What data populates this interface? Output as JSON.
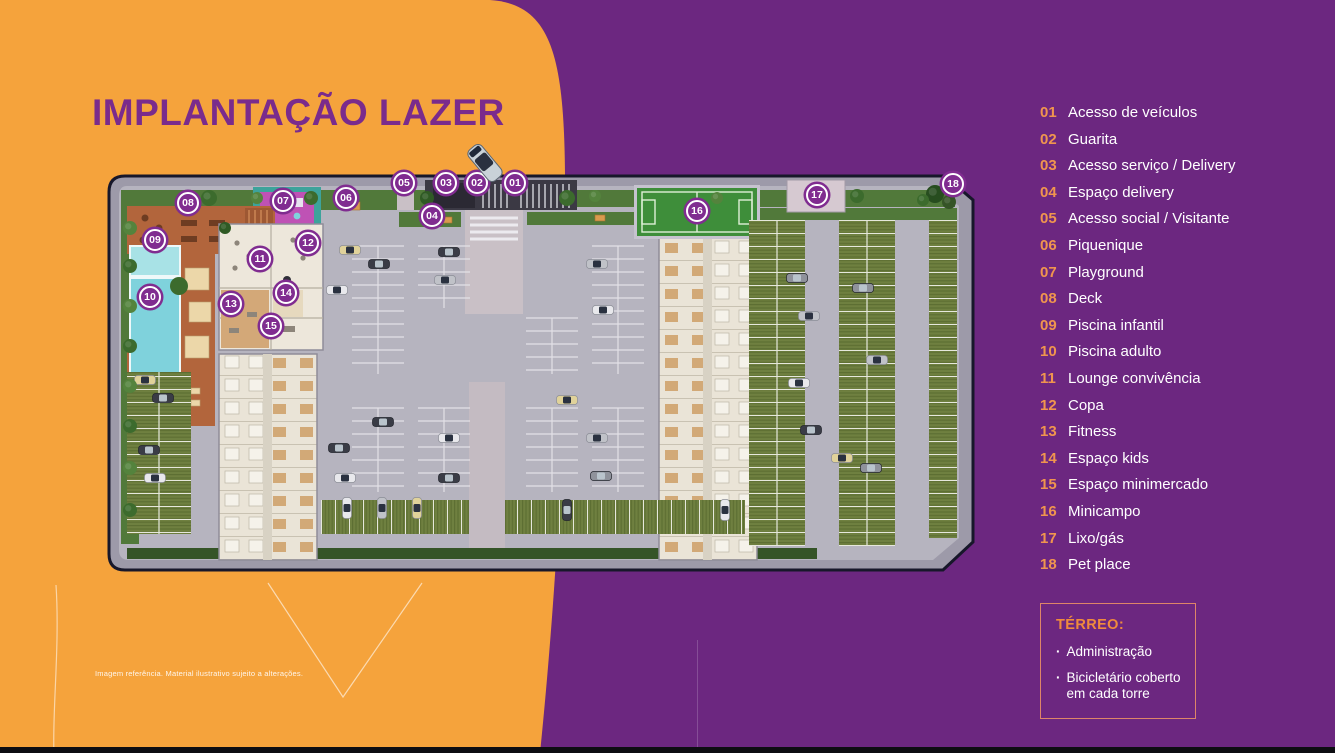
{
  "title": "IMPLANTAÇÃO LAZER",
  "legend": {
    "items": [
      {
        "num": "01",
        "label": "Acesso de veículos"
      },
      {
        "num": "02",
        "label": "Guarita"
      },
      {
        "num": "03",
        "label": "Acesso serviço / Delivery"
      },
      {
        "num": "04",
        "label": "Espaço delivery"
      },
      {
        "num": "05",
        "label": "Acesso social / Visitante"
      },
      {
        "num": "06",
        "label": "Piquenique"
      },
      {
        "num": "07",
        "label": "Playground"
      },
      {
        "num": "08",
        "label": "Deck"
      },
      {
        "num": "09",
        "label": "Piscina infantil"
      },
      {
        "num": "10",
        "label": "Piscina adulto"
      },
      {
        "num": "11",
        "label": "Lounge convivência"
      },
      {
        "num": "12",
        "label": "Copa"
      },
      {
        "num": "13",
        "label": "Fitness"
      },
      {
        "num": "14",
        "label": "Espaço kids"
      },
      {
        "num": "15",
        "label": "Espaço minimercado"
      },
      {
        "num": "16",
        "label": "Minicampo"
      },
      {
        "num": "17",
        "label": "Lixo/gás"
      },
      {
        "num": "18",
        "label": "Pet place"
      }
    ]
  },
  "terreo_box": {
    "heading": "TÉRREO:",
    "items": [
      "Administração",
      "Bicicletário coberto em cada torre"
    ]
  },
  "disclaimer": "Imagem referência. Material ilustrativo sujeito a alterações.",
  "plan": {
    "markers": [
      {
        "num": "01",
        "x": 418,
        "y": 15
      },
      {
        "num": "02",
        "x": 380,
        "y": 15
      },
      {
        "num": "03",
        "x": 349,
        "y": 15
      },
      {
        "num": "04",
        "x": 335,
        "y": 48
      },
      {
        "num": "05",
        "x": 307,
        "y": 15
      },
      {
        "num": "06",
        "x": 249,
        "y": 30
      },
      {
        "num": "07",
        "x": 186,
        "y": 33
      },
      {
        "num": "08",
        "x": 91,
        "y": 35
      },
      {
        "num": "09",
        "x": 58,
        "y": 72
      },
      {
        "num": "10",
        "x": 53,
        "y": 129
      },
      {
        "num": "11",
        "x": 163,
        "y": 91
      },
      {
        "num": "12",
        "x": 211,
        "y": 75
      },
      {
        "num": "13",
        "x": 134,
        "y": 136
      },
      {
        "num": "14",
        "x": 189,
        "y": 125
      },
      {
        "num": "15",
        "x": 174,
        "y": 158
      },
      {
        "num": "16",
        "x": 600,
        "y": 43
      },
      {
        "num": "17",
        "x": 720,
        "y": 27
      },
      {
        "num": "18",
        "x": 856,
        "y": 16
      }
    ]
  },
  "colors": {
    "orange": "#F5A33C",
    "purple": "#6C2780",
    "title": "#7A2B8C",
    "legend_number": "#F0954E",
    "marker": "#802C90",
    "terreo_heading": "#F08B3C"
  }
}
